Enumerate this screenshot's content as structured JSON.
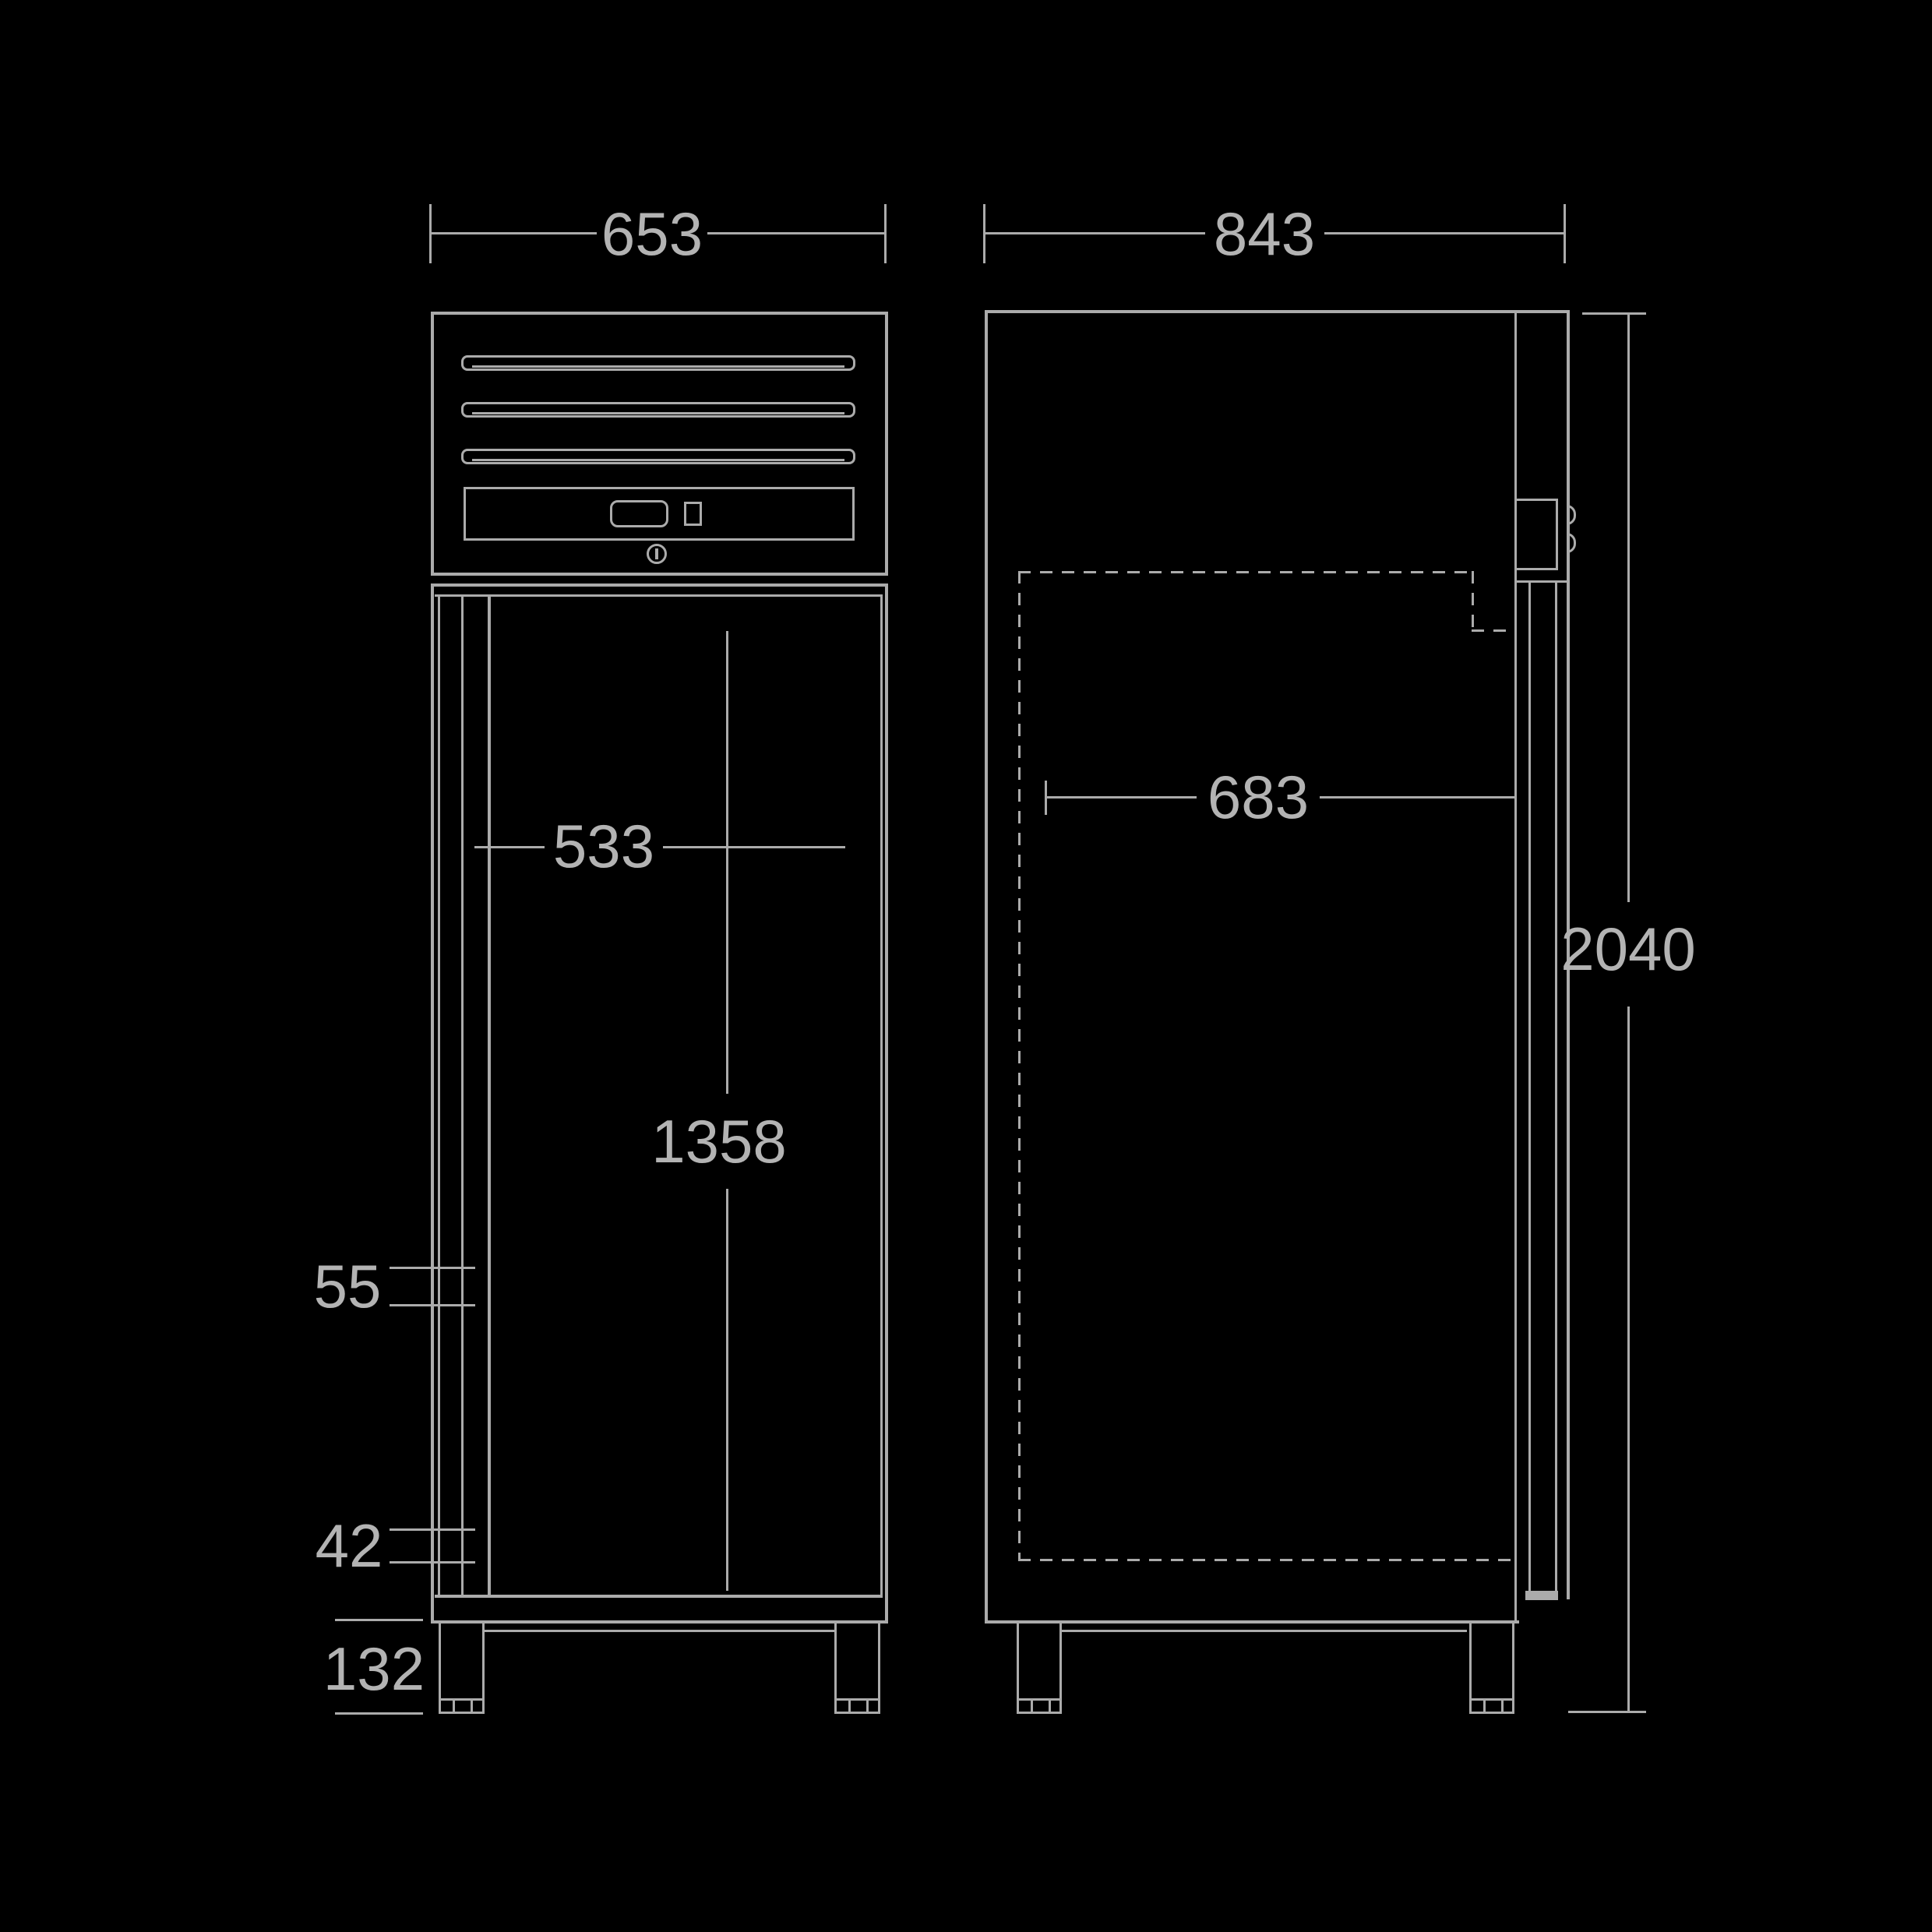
{
  "diagram": {
    "kind": "technical-dimension-drawing",
    "subject": "upright-cabinet-front-and-side-views"
  },
  "colors": {
    "background": "#000000",
    "stroke": "#ababab",
    "text": "#b3b3b3"
  },
  "views": {
    "front": {
      "dimensions": {
        "overall_width": "653",
        "inner_width": "533",
        "door_height": "1358",
        "detail_upper": "55",
        "detail_lower": "42",
        "foot_height": "132"
      }
    },
    "side": {
      "dimensions": {
        "overall_depth": "843",
        "inner_depth": "683",
        "overall_height": "2040"
      }
    }
  }
}
